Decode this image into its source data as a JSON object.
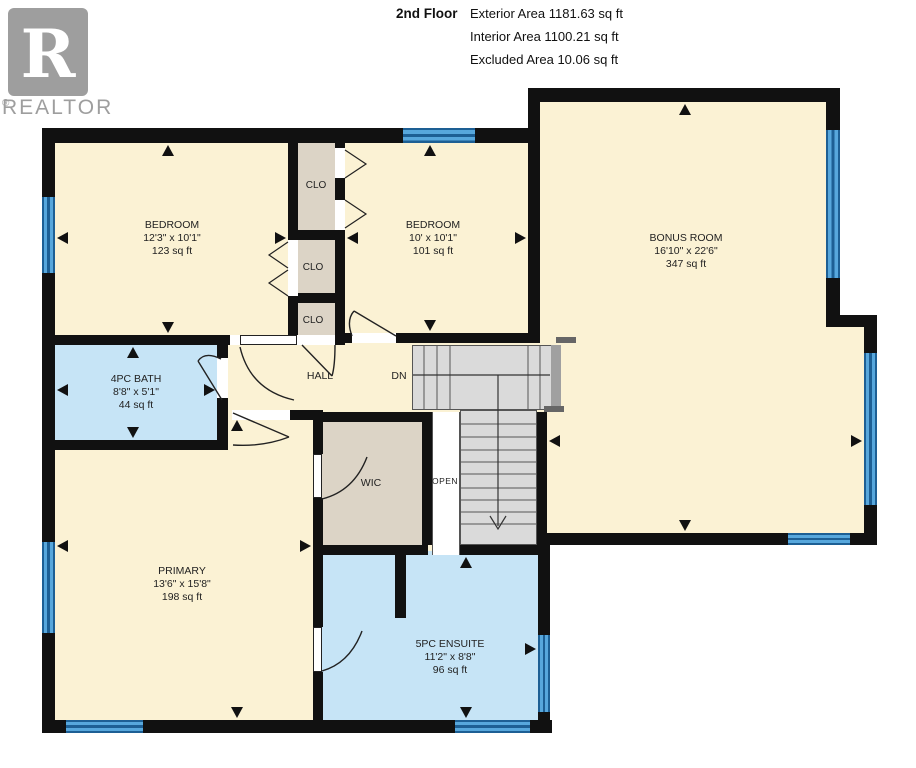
{
  "header": {
    "floor_label": "2nd Floor",
    "area_lines": [
      "Exterior Area 1181.63 sq ft",
      "Interior Area 1100.21 sq ft",
      "Excluded Area 10.06 sq ft"
    ]
  },
  "logo": {
    "letter": "R",
    "brand": "REALTOR",
    "registered": "®"
  },
  "rooms": {
    "bedroom1": {
      "name": "BEDROOM",
      "dims": "12'3\" x 10'1\"",
      "area": "123 sq ft"
    },
    "bedroom2": {
      "name": "BEDROOM",
      "dims": "10' x 10'1\"",
      "area": "101 sq ft"
    },
    "bonus": {
      "name": "BONUS ROOM",
      "dims": "16'10\" x 22'6\"",
      "area": "347 sq ft"
    },
    "bath": {
      "name": "4PC BATH",
      "dims": "8'8\" x 5'1\"",
      "area": "44 sq ft"
    },
    "primary": {
      "name": "PRIMARY",
      "dims": "13'6\" x 15'8\"",
      "area": "198 sq ft"
    },
    "ensuite": {
      "name": "5PC ENSUITE",
      "dims": "11'2\" x 8'8\"",
      "area": "96 sq ft"
    }
  },
  "labels": {
    "hall": "HALL",
    "down": "DN",
    "wic": "WIC",
    "open": "OPEN",
    "closet": "CLO"
  },
  "colors": {
    "wall": "#111111",
    "room_cream": "#FBF2D4",
    "room_blue": "#C6E4F6",
    "room_tan": "#DCD4C6",
    "stairs": "#DADADA",
    "window_blue": "#4C9BD2",
    "window_dark": "#1D5F94",
    "logo_gray": "#9E9E9E"
  }
}
